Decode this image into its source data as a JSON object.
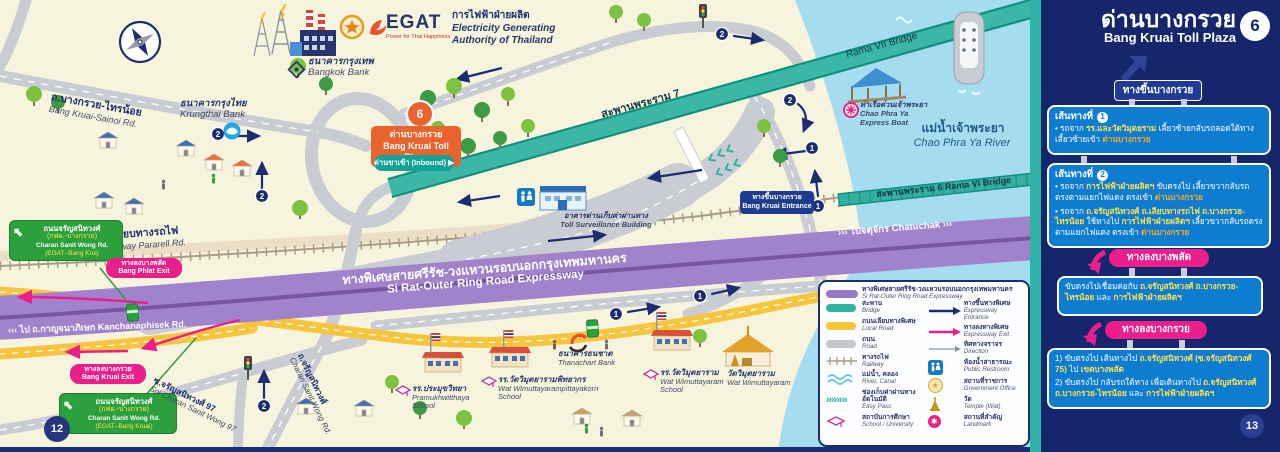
{
  "colors": {
    "navy": "#1B2C6F",
    "teal_bridge": "#3BB7A6",
    "purple_expressway": "#9C7CC9",
    "pink_exit": "#EC1E8C",
    "green_sign": "#2BA03C",
    "orange_sign": "#E9632F",
    "route_box_blue": "#0E7DD1",
    "highlight_yellow": "#FFE14D",
    "highlight_orange": "#F7A823",
    "river_blue": "#A6DCEF",
    "local_road_yellow": "#F6C53E",
    "sidebar_navy": "#16266D"
  },
  "map": {
    "egat": {
      "logo_text": "EGAT",
      "tagline": "Power for Thai Happiness",
      "name_th": "การไฟฟ้าฝ่ายผลิต",
      "name_en1": "Electricity Generating",
      "name_en2": "Authority of Thailand"
    },
    "banks": {
      "bangkok_th": "ธนาคารกรุงเทพ",
      "bangkok_en": "Bangkok Bank",
      "krungthai_th": "ธนาคารกรุงไทย",
      "krungthai_en": "Krungthai Bank",
      "thanachart_th": "ธนาคารธนชาต",
      "thanachart_en": "Thanachart Bank"
    },
    "roads": {
      "sainoi_th": "ถ.บางกรวย-ไทรน้อย",
      "sainoi_en": "Bang Kruai-Sainoi Rd.",
      "railway_parallel_th": "ถ.เลียบทางรถไฟ",
      "railway_parallel_en": "Railway Pararell Rd.",
      "expressway_th": "ทางพิเศษสายศรีรัช-วงแหวนรอบนอกกรุงเทพมหานคร",
      "expressway_en": "Si Rat-Outer Ring Road Expressway",
      "kanchanaphisek": "ไป ถ.กาญจนาภิเษก Kanchanaphisek Rd.",
      "chatuchak": "ไปจตุจักร Chatuchak",
      "chev_left": "‹‹‹",
      "chev_right": "›››",
      "soi97_th": "ซ.จรัญสนิทวงศ์ 97",
      "soi97_en": "Soi Charan Sanit Wong 97",
      "charan_th": "ถ.จรัญสนิทวงศ์",
      "charan_en": "Charan Sanit Wong Rd."
    },
    "bridges": {
      "rama7_th": "สะพานพระราม 7",
      "rama7_en": "Rama VII Bridge",
      "rama6": "สะพานพระราม 6  Rama VI Bridge"
    },
    "river": {
      "th": "แม่น้ำเจ้าพระยา",
      "en": "Chao Phra Ya River"
    },
    "boat": {
      "th": "ท่าเรือด่วนเจ้าพระยา",
      "en1": "Chao Phra Ya",
      "en2": "Express Boat"
    },
    "toll_sign": {
      "number": "6",
      "th": "ด่านบางกรวย",
      "en": "Bang Kruai Toll Plaza",
      "inbound": "ด่านขาเข้า (Inbound) ▶"
    },
    "entrance_badge": {
      "th": "ทางขึ้นบางกรวย",
      "en": "Bang Kruai Entrance"
    },
    "surveillance": {
      "th": "อาคารด่านเก็บค่าผ่านทาง",
      "en": "Toll Surveillance Building"
    },
    "green_sign1": {
      "l1": "ถนนจรัญสนิทวงศ์",
      "l2": "(กฟผ.-บางกรวย)",
      "l3": "Charan Sanit Wong Rd.",
      "l4": "(EGAT–Bang Krui)"
    },
    "green_sign2": {
      "l1": "ถนนจรัญสนิทวงศ์",
      "l2": "(กฟผ.-บางกรวย)",
      "l3": "Charan Sanit Wong Rd.",
      "l4": "(EGAT–Bang Kruai)"
    },
    "exit_phlat": {
      "th": "ทางลงบางพลัด",
      "en": "Bang Phlat Exit"
    },
    "exit_kruai": {
      "th": "ทางลงบางกรวย",
      "en": "Bang Kruai Exit"
    },
    "schools": {
      "s1_th": "รร.ประมุขวิทยา",
      "s1_en1": "Pramukhwitthaya",
      "s1_en2": "School",
      "s2_th": "รร.วัดวิมุตยารามพิทยากร",
      "s2_en1": "Wat Wimuttayarampittayakorn",
      "s2_en2": "School",
      "s3_th": "รร.วัดวิมุตยาราม",
      "s3_en1": "Wat Wimuttayaram",
      "s3_en2": "School"
    },
    "temple": {
      "th": "วัดวิมุตยาราม",
      "en": "Wat Wimuttayaram"
    },
    "marker1": "1",
    "marker2": "2",
    "page_number": "12"
  },
  "legend": {
    "row_expressway": {
      "th": "ทางพิเศษสายศรีรัช-วงแหวนรอบนอกกรุงเทพมหานคร",
      "en": "Si Rat-Outer Ring Road Expressway"
    },
    "left": [
      {
        "th": "สะพาน",
        "en": "Bridge"
      },
      {
        "th": "ถนนเลียบทางพิเศษ",
        "en": "Local Road"
      },
      {
        "th": "ถนน",
        "en": "Road"
      },
      {
        "th": "ทางรถไฟ",
        "en": "Railway"
      },
      {
        "th": "แม่น้ำ, คลอง",
        "en": "River, Canal"
      },
      {
        "th": "ช่องเก็บค่าผ่านทางอัตโนมัติ",
        "en": "Easy Pass"
      },
      {
        "th": "สถาบันการศึกษา",
        "en": "School / University"
      }
    ],
    "right": [
      {
        "th": "ทางขึ้นทางพิเศษ",
        "en": "Expressway Entrance"
      },
      {
        "th": "ทางลงทางพิเศษ",
        "en": "Expressway Exit"
      },
      {
        "th": "ทิศทางจราจร",
        "en": "Direction"
      },
      {
        "th": "ห้องน้ำสาธารณะ",
        "en": "Public Restroom"
      },
      {
        "th": "สถานที่ราชการ",
        "en": "Government Office"
      },
      {
        "th": "วัด",
        "en": "Temple (Wat)"
      },
      {
        "th": "สถานที่สำคัญ",
        "en": "Landmark"
      }
    ],
    "icons": {
      "easypass": "»»»»",
      "star": "★",
      "landmark": "✱",
      "wc": "♿"
    }
  },
  "sidebar": {
    "title_th": "ด่านบางกรวย",
    "title_en": "Bang Kruai Toll Plaza",
    "page_badge": "6",
    "entrance_sign": "ทางขึ้นบางกรวย",
    "route1": {
      "header": "เส้นทางที่",
      "num": "1",
      "s1": "• รถจาก ",
      "s2": "รร.และวัดวิมุตยราม",
      "s3": " เลี้ยวซ้ายกลับรถลอดใต้ทาง เลี้ยวซ้ายเข้า ",
      "s4": "ด่านบางกรวย"
    },
    "route2": {
      "header": "เส้นทางที่",
      "num": "2",
      "b1s1": "• รถจาก ",
      "b1s2": "การไฟฟ้าฝ่ายผลิตฯ",
      "b1s3": " ขับตรงไป เลี้ยวขวากลับรถ ตรงตามแยกไฟแดง ตรงเข้า ",
      "b1s4": "ด่านบางกรวย",
      "b2s1": "• รถจาก ",
      "b2s2": "ถ.จรัญสนิทวงศ์ ถ.เลียบทางรถไฟ ถ.บางกรวย-ไทรน้อย",
      "b2s3": " ใช้ทางไป ",
      "b2s4": "การไฟฟ้าฝ่ายผลิตฯ",
      "b2s5": " เลี้ยวขวากลับรถตรงตามแยกไฟแดง ตรงเข้า ",
      "b2s6": "ด่านบางกรวย"
    },
    "exit_phlat_sign": "ทางลงบางพลัด",
    "phlat_box": {
      "s1": "ขับตรงไปเชื่อมต่อกับ ",
      "s2": "ถ.จรัญสนิทวงศ์ ถ.บางกรวย-ไทรน้อย",
      "s3": " และ ",
      "s4": "การไฟฟ้าฝ่ายผลิตฯ"
    },
    "exit_kruai_sign": "ทางลงบางกรวย",
    "kruai_box": {
      "l1s1": "1) ขับตรงไป เส้นทางไป ",
      "l1s2": "ถ.จรัญสนิทวงศ์ (ซ.จรัญสนิทวงศ์ 75)",
      "l1s3": " ไป ",
      "l1s4": "เขตบางพลัด",
      "l2s1": "2) ขับตรงไป กลับรถใต้ทาง เพื่อเดินทางไป ",
      "l2s2": "ถ.จรัญสนิทวงศ์ ถ.บางกรวย-ไทรน้อย",
      "l2s3": " และ ",
      "l2s4": "การไฟฟ้าฝ่ายผลิตฯ"
    },
    "page_number": "13"
  }
}
